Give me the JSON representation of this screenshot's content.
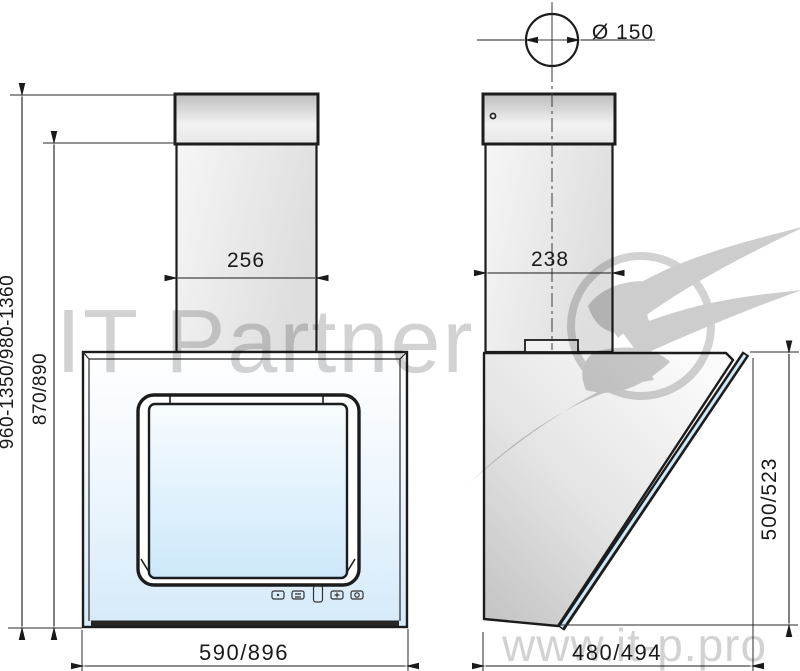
{
  "watermark": {
    "brand": "IT Partner",
    "website": "www.it-p.pro"
  },
  "dimensions": {
    "duct_diameter": "Ø 150",
    "chimney_width_front": "256",
    "chimney_depth_side": "238",
    "overall_height_range": "960-1350/980-1360",
    "body_height_range": "870/890",
    "body_width": "590/896",
    "body_depth": "480/494",
    "glass_panel_height": "500/523"
  },
  "colors": {
    "line": "#1c1c1c",
    "glass_blue": "#cde9fa",
    "steel_gray": "#d9d9d9",
    "watermark_gray": "#d2d2d2"
  }
}
